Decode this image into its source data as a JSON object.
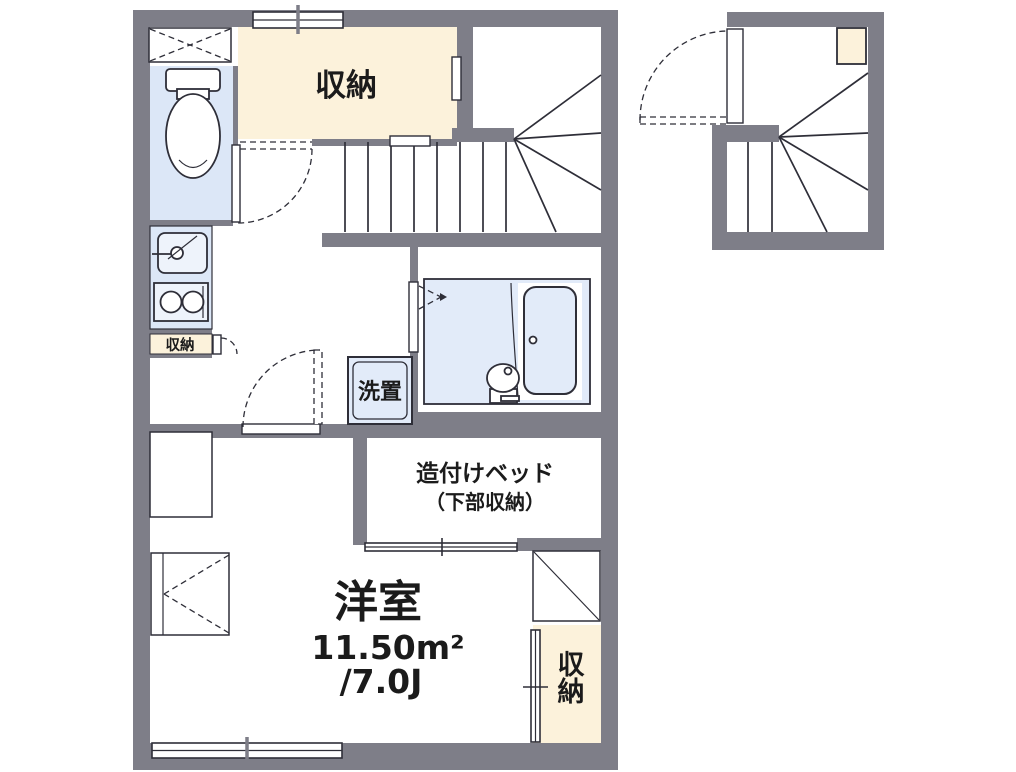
{
  "palette": {
    "wall": "#7E7E88",
    "cream": "#FCF2DB",
    "blue": "#DCE7F7",
    "bath_blue": "#E2EBF9",
    "line": "#2E2E38"
  },
  "labels": {
    "storage_top": "収納",
    "storage_side": "収納",
    "washer": "洗置",
    "bed_line1": "造付けベッド",
    "bed_line2": "（下部収納）",
    "room_name": "洋室",
    "room_area": "11.50m²",
    "room_tatami": "/7.0J",
    "storage_bottom": "収納"
  }
}
